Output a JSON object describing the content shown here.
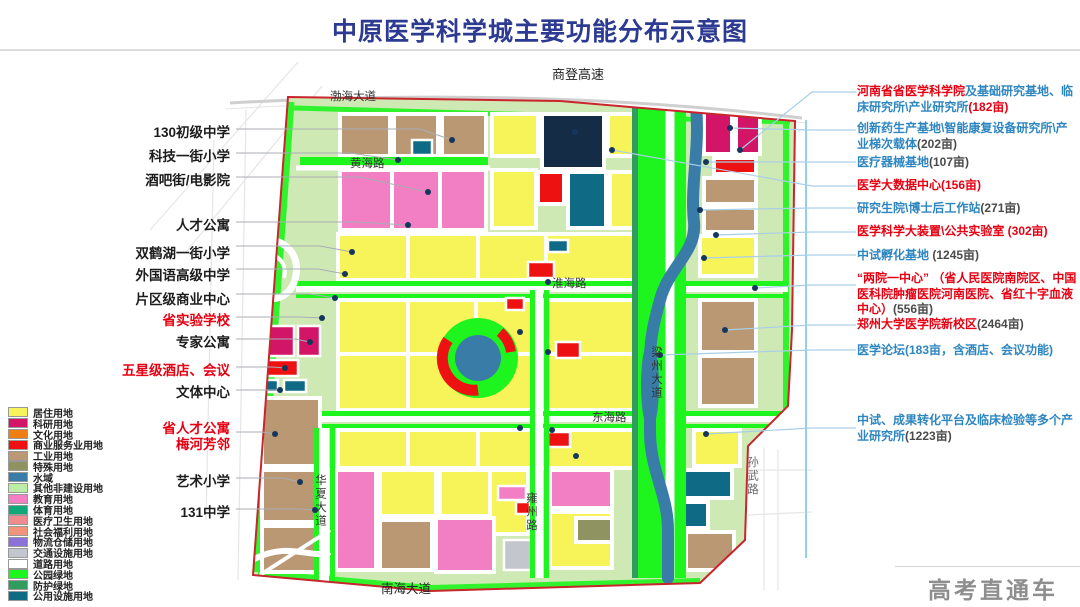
{
  "title": "中原医学科学城主要功能分布示意图",
  "watermark": "高考直通车",
  "palette": {
    "res": "#f7f45a",
    "sci": "#d31567",
    "cul": "#f07f13",
    "com": "#ee1111",
    "ind": "#b99873",
    "spec": "#8e9361",
    "water": "#3a7ca8",
    "other": "#bdeca4",
    "edu": "#f27ec4",
    "sport": "#0fa878",
    "med": "#ef8b8f",
    "wel": "#f2937b",
    "log": "#8b72d8",
    "trans": "#c4c6ce",
    "roadw": "#ffffff",
    "park": "#1ef41e",
    "green2": "#2f9d5d",
    "pub": "#0e6a85",
    "navy": "#152c46",
    "base": "#cfe9b4",
    "boundary": "#c9252c",
    "calloutRed": "#e60012",
    "calloutBlue": "#2e86c1",
    "calloutDark": "#4a4a4a"
  },
  "legend": {
    "items": [
      {
        "label": "居住用地",
        "color": "#f7f45a"
      },
      {
        "label": "科研用地",
        "color": "#d31567"
      },
      {
        "label": "文化用地",
        "color": "#f07f13"
      },
      {
        "label": "商业服务业用地",
        "color": "#ee1111"
      },
      {
        "label": "工业用地",
        "color": "#b99873"
      },
      {
        "label": "特殊用地",
        "color": "#8e9361"
      },
      {
        "label": "水域",
        "color": "#3a7ca8"
      },
      {
        "label": "其他非建设用地",
        "color": "#bdeca4"
      },
      {
        "label": "教育用地",
        "color": "#f27ec4"
      },
      {
        "label": "体育用地",
        "color": "#0fa878"
      },
      {
        "label": "医疗卫生用地",
        "color": "#ef8b8f"
      },
      {
        "label": "社会福利用地",
        "color": "#f2937b"
      },
      {
        "label": "物流仓储用地",
        "color": "#8b72d8"
      },
      {
        "label": "交通设施用地",
        "color": "#c4c6ce"
      },
      {
        "label": "道路用地",
        "color": "#ffffff"
      },
      {
        "label": "公园绿地",
        "color": "#1ef41e"
      },
      {
        "label": "防护绿地",
        "color": "#2f9d5d"
      },
      {
        "label": "公用设施用地",
        "color": "#0e6a85"
      }
    ]
  },
  "roads": [
    {
      "text": "商登高速"
    },
    {
      "text": "渤海大道"
    },
    {
      "text": "黄海路"
    },
    {
      "text": "淮海路"
    },
    {
      "text": "东海路"
    },
    {
      "text": "南海大道"
    },
    {
      "text": "华夏大道"
    },
    {
      "text": "雍州路"
    },
    {
      "text": "梁州大道"
    },
    {
      "text": "孙武路"
    }
  ],
  "left_callouts": [
    {
      "lines": [
        "130初级中学"
      ],
      "color": "black"
    },
    {
      "lines": [
        "科技一街小学"
      ],
      "color": "black"
    },
    {
      "lines": [
        "酒吧街/电影院"
      ],
      "color": "black"
    },
    {
      "lines": [
        "人才公寓"
      ],
      "color": "black"
    },
    {
      "lines": [
        "双鹤湖一街小学"
      ],
      "color": "black"
    },
    {
      "lines": [
        "外国语高级中学"
      ],
      "color": "black"
    },
    {
      "lines": [
        "片区级商业中心"
      ],
      "color": "black"
    },
    {
      "lines": [
        "省实验学校"
      ],
      "color": "red"
    },
    {
      "lines": [
        "专家公寓"
      ],
      "color": "black"
    },
    {
      "lines": [
        "五星级酒店、会议"
      ],
      "color": "red"
    },
    {
      "lines": [
        "文体中心"
      ],
      "color": "black"
    },
    {
      "lines": [
        "省人才公寓",
        "梅河芳邻"
      ],
      "color": "red"
    },
    {
      "lines": [
        "艺术小学"
      ],
      "color": "black"
    },
    {
      "lines": [
        "131中学"
      ],
      "color": "black"
    }
  ],
  "right_callouts": [
    {
      "segments": [
        {
          "text": "河南省省医学科学院",
          "color": "red"
        },
        {
          "text": "及基础研究基地、临床研究所\\产业研究所",
          "color": "blue"
        },
        {
          "text": "(182亩)",
          "color": "red"
        }
      ]
    },
    {
      "segments": [
        {
          "text": "创新药生产基地\\智能康复设备研究所\\产业梯次载体",
          "color": "blue"
        },
        {
          "text": "(202亩)",
          "color": "dark"
        }
      ]
    },
    {
      "segments": [
        {
          "text": "医疗器械基地",
          "color": "blue"
        },
        {
          "text": "(107亩)",
          "color": "dark"
        }
      ]
    },
    {
      "segments": [
        {
          "text": "医学大数据中心(156亩)",
          "color": "red"
        }
      ]
    },
    {
      "segments": [
        {
          "text": "研究生院\\博士后工作站",
          "color": "blue"
        },
        {
          "text": "(271亩)",
          "color": "dark"
        }
      ]
    },
    {
      "segments": [
        {
          "text": "医学科学大装置\\公共实验室 (302亩)",
          "color": "red"
        }
      ]
    },
    {
      "segments": [
        {
          "text": "中试孵化基地 ",
          "color": "blue"
        },
        {
          "text": "(1245亩)",
          "color": "dark"
        }
      ]
    },
    {
      "segments": [
        {
          "text": "“两院一中心” （省人民医院南院区、中国医科院肿瘤医院河南医院、省红十字血液中心）",
          "color": "red"
        },
        {
          "text": "(556亩)",
          "color": "dark"
        }
      ]
    },
    {
      "segments": [
        {
          "text": "郑州大学医学院新校区",
          "color": "red"
        },
        {
          "text": "(2464亩)",
          "color": "dark"
        }
      ]
    },
    {
      "segments": [
        {
          "text": "医学论坛(183亩，含酒店、会议功能)",
          "color": "blue"
        }
      ]
    },
    {
      "segments": [
        {
          "text": "中试、成果转化平台及临床检验等多个产业研究所",
          "color": "blue"
        },
        {
          "text": "(1223亩)",
          "color": "dark"
        }
      ]
    }
  ]
}
